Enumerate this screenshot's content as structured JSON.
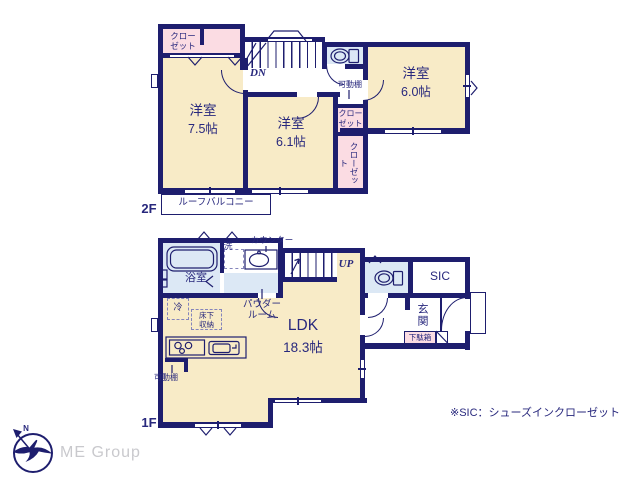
{
  "colors": {
    "wall": "#1e1e6e",
    "text": "#28287d",
    "room_cream": "#f8ebc7",
    "closet_pink": "#fbdce3",
    "wet_blue": "#dce8f5",
    "logo_gray": "#c9c9cd"
  },
  "floor2": {
    "label": "2F",
    "bed75": {
      "name": "洋室",
      "size": "7.5帖"
    },
    "bed61": {
      "name": "洋室",
      "size": "6.1帖"
    },
    "bed60": {
      "name": "洋室",
      "size": "6.0帖"
    },
    "closet_top": "クローゼット",
    "closet_mid": "クローゼット",
    "closet_side": "クローゼット",
    "shelf": "可動棚",
    "stairs_down": "DN",
    "balcony": "ルーフバルコニー"
  },
  "floor1": {
    "label": "1F",
    "ldk": {
      "name": "LDK",
      "size": "18.3帖"
    },
    "bath": "浴室",
    "laundry": "洗",
    "counter": "カウンター",
    "powder": "パウダールーム",
    "fridge": "冷",
    "underfloor": "床下収納",
    "stairs_up": "UP",
    "sic": "SIC",
    "entrance": "玄関",
    "shoe_box": "下駄箱",
    "shelf": "可動棚"
  },
  "footer": {
    "note": "※SIC：シューズインクローゼット",
    "logo": "ME Group",
    "compass_n": "N"
  }
}
